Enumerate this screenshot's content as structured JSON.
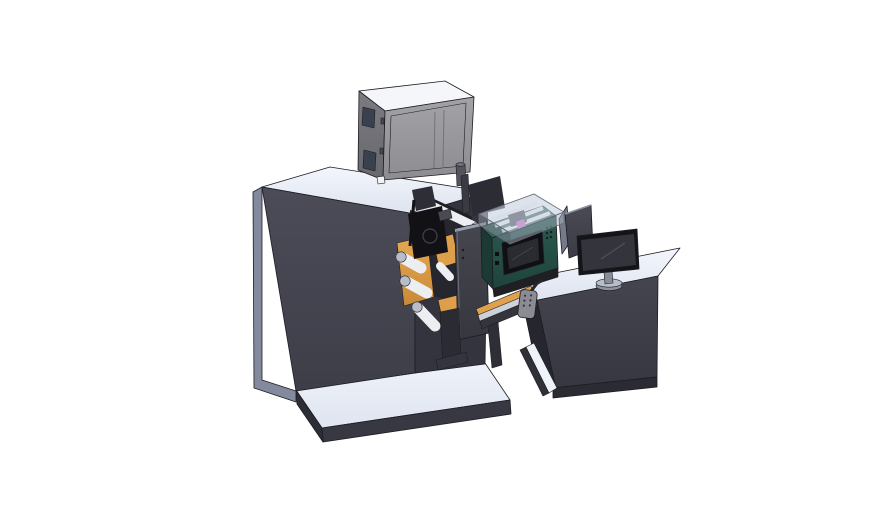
{
  "canvas": {
    "width": 888,
    "height": 522,
    "background": "#ffffff"
  },
  "colors": {
    "outline": "#1c1c22",
    "topLightA": "#f3f6fc",
    "topLightB": "#dde3ef",
    "bodyFrontA": "#4c4c58",
    "bodyFrontB": "#3e3e49",
    "bodySide": "#34343e",
    "bodyLeft": "#838a9d",
    "platformTopA": "#eef2f9",
    "platformTopB": "#dfe5f1",
    "platformEdge": "#383842",
    "platformLeft": "#2d2d36",
    "cabinetTop": "#f4f6f9",
    "cabinetFrontA": "#a3a3a7",
    "cabinetFrontB": "#8c8c91",
    "cabinetLeftA": "#7b7b80",
    "cabinetLeftB": "#67686d",
    "cabinetWindow": "#39404e",
    "cabinetLine": "#72727a",
    "cabinetSquare": "#f2f4f7",
    "filterBody": "#54545e",
    "filterCap": "#70707a",
    "recess": "#26262e",
    "railDark": "#1f1f24",
    "roller": "#eceef2",
    "rollerEnd": "#b9bdc8",
    "webA": "#e6a852",
    "webB": "#c98a38",
    "webFlat": "#dd9f49",
    "printheadDark": "#121216",
    "printheadMid": "#2e2e36",
    "printheadLight": "#4a4a52",
    "doorA": "#46464f",
    "doorB": "#37373f",
    "doorEdge": "#9aa0ad",
    "doorHighlight": "#6a6e7a",
    "supportDark": "#2b2b33",
    "footDark": "#34343e",
    "greenTop": "#356055",
    "greenLeft": "#1b3a33",
    "greenFrontA": "#2c5a50",
    "greenFrontB": "#1e443c",
    "hmiBezel": "#101014",
    "hmiScreen": "#2a2a31",
    "hmiGlare": "#44444c",
    "buttonDark": "#0e0e12",
    "ventDot": "#10241f",
    "backMass": "#2c2c35",
    "backPost": "#3a3a43",
    "glassTop": "rgba(197,209,222,0.60)",
    "glassFront": "rgba(166,177,192,0.50)",
    "glassLeft": "rgba(140,148,162,0.50)",
    "glassEdge": "#646a76",
    "innerRoller": "#f4f5f8",
    "innerPart": "#3f3f47",
    "pinkPart": "#c95fc0",
    "beltOrange": "#e0a14d",
    "railSilver": "#cdd1d9",
    "frameDark": "#34343d",
    "legDark": "#2e2e37",
    "pendantBody": "#8b8b93",
    "pendantDot": "#33333a",
    "pendantArm": "#26262c",
    "deskFrontA": "#454550",
    "deskFrontB": "#373741",
    "deskLeft": "#26262f",
    "deskPlinth": "#2b2b34",
    "deskStrip": "#303039",
    "deskWedge": "#eef2f9",
    "shieldBack": "#747a8a",
    "shieldFrontA": "#4a4a55",
    "shieldFrontB": "#3c3c46",
    "shieldEdge": "#8e94a2",
    "monitorBezel": "#141419",
    "monitorScreen": "#34343c",
    "monitorGlare": "#50505a",
    "standNeck": "#888c96",
    "standBaseTop": "#b7bdc9",
    "standBase": "#8e939e"
  }
}
